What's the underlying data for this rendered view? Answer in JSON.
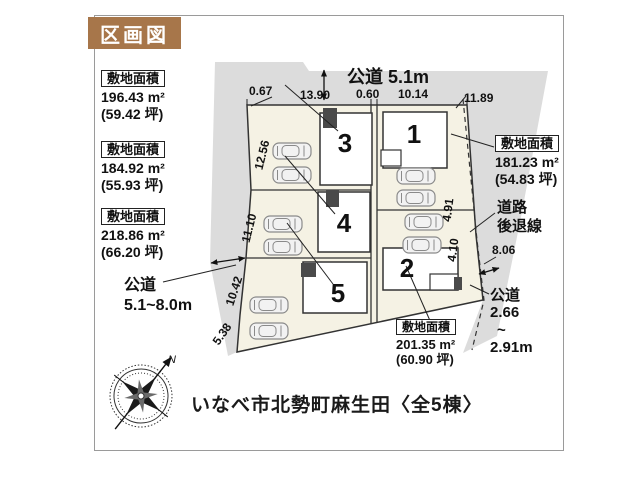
{
  "title": "区画図",
  "address_line": "いなべ市北勢町麻生田〈全5棟〉",
  "compass": {
    "north_label": "N"
  },
  "colors": {
    "accent_brown": "#a7764a",
    "road_gray": "#dcdcdc",
    "parcel_cream": "#f5f2e4",
    "line_dark": "#333333"
  },
  "site_labels": [
    {
      "lot": "3",
      "heading": "敷地面積",
      "area_m2": "196.43 m²",
      "area_tsubo": "(59.42 坪)"
    },
    {
      "lot": "4",
      "heading": "敷地面積",
      "area_m2": "184.92 m²",
      "area_tsubo": "(55.93 坪)"
    },
    {
      "lot": "5",
      "heading": "敷地面積",
      "area_m2": "218.86 m²",
      "area_tsubo": "(66.20 坪)"
    },
    {
      "lot": "1",
      "heading": "敷地面積",
      "area_m2": "181.23 m²",
      "area_tsubo": "(54.83 坪)"
    },
    {
      "lot": "2",
      "heading": "敷地面積",
      "area_m2": "201.35 m²",
      "area_tsubo": "(60.90 坪)"
    }
  ],
  "roads": {
    "top": "公道 5.1m",
    "left_line1": "公道",
    "left_line2": "5.1~8.0m",
    "right_line1": "公道",
    "right_line2": "2.66",
    "right_line3": "~",
    "right_line4": "2.91m",
    "setback_line1": "道路",
    "setback_line2": "後退線"
  },
  "dimensions": {
    "top": [
      "0.67",
      "13.90",
      "0.60",
      "10.14",
      "11.89"
    ],
    "left": [
      "12.56",
      "11.10",
      "10.42",
      "5.38"
    ],
    "right": [
      "4.91",
      "4.10",
      "8.06"
    ]
  },
  "lots": [
    {
      "number": "1"
    },
    {
      "number": "2"
    },
    {
      "number": "3"
    },
    {
      "number": "4"
    },
    {
      "number": "5"
    }
  ]
}
